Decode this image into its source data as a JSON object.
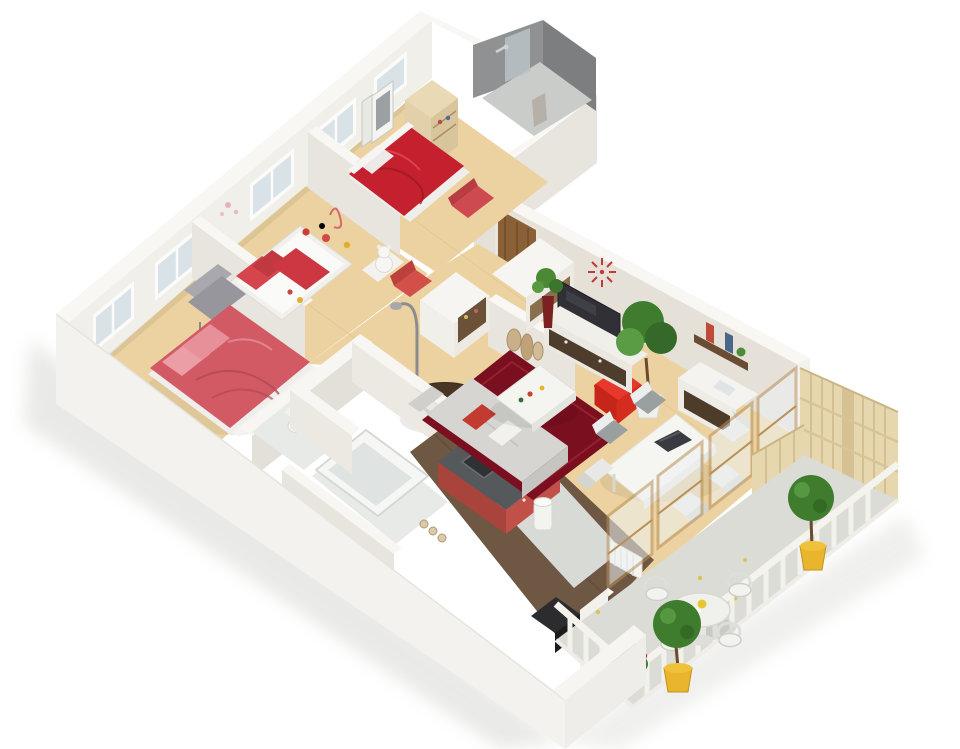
{
  "scene": {
    "type": "3d-isometric-floor-plan-render",
    "subject": "Furnished apartment dollhouse cutaway: three bedrooms, shower room, bathroom, kitchen, living-dining room and terrace balcony",
    "background": "#ffffff",
    "image_width_px": 960,
    "image_height_px": 749,
    "text_labels": "none"
  },
  "palette": {
    "wall_top": "#f8f7f3",
    "wall_inner": "#f1efe9",
    "wall_shadow": "#e8e5df",
    "wall_dark": "#dcd9d2",
    "wood_floor": "#ebd2a0",
    "tile_floor": "#e7eae6",
    "kitchen_floor": "#6e5743",
    "balcony_floor": "#dcdcd6",
    "rug_red": "#7a0f1f",
    "bed_red": "#c5202e",
    "bed_pink": "#d25a64",
    "accent_red": "#e6392c",
    "sofa_gray": "#d6d5d1",
    "door_wood": "#8a6136",
    "furniture_wood": "#4e3d2d",
    "fence_wood": "#e7d7ae",
    "railing_white": "#f4f3ee",
    "plant_green": "#3f7c2e",
    "plant_green_light": "#5a9c44",
    "pot_yellow": "#e8b52c",
    "shower_tile": "#8f9192",
    "glass": "#b9c2c6",
    "counter_red": "#c05048",
    "counter_top": "#55595c"
  },
  "rooms": [
    {
      "id": "master-bedroom",
      "position": "lower-left",
      "floor": "wood",
      "items": [
        "double-bed-pink",
        "gray-armchair",
        "two-windows"
      ]
    },
    {
      "id": "kids-bedroom",
      "position": "center-left",
      "floor": "wood",
      "items": [
        "kids-bed-red-pillows",
        "toys",
        "teddy-bear",
        "red-kid-armchair",
        "window"
      ]
    },
    {
      "id": "bedroom-3",
      "position": "top-center",
      "floor": "wood",
      "items": [
        "double-bed-red-duvet",
        "wardrobe",
        "picture-frames",
        "red-bench"
      ]
    },
    {
      "id": "shower-room",
      "position": "top-right-block",
      "floor": "gray-tile",
      "items": [
        "glass-shower",
        "hanging-robe"
      ]
    },
    {
      "id": "entry-hall",
      "position": "center",
      "floor": "wood",
      "items": [
        "entrance-door",
        "dresser-cabinets",
        "arc-floor-lamp",
        "round-dark-table"
      ]
    },
    {
      "id": "bathroom-wc",
      "position": "bottom-center-left",
      "floor": "white-tile",
      "items": [
        "bathtub",
        "toilet"
      ]
    },
    {
      "id": "kitchen",
      "position": "bottom-center",
      "floor": "dark-wood",
      "items": [
        "l-counter-red-front",
        "sink",
        "trash-bin",
        "oven",
        "bottles",
        "radiator"
      ]
    },
    {
      "id": "living-dining",
      "position": "center-right",
      "floor": "wood",
      "items": [
        "dark-red-rug",
        "white-coffee-table",
        "gray-corner-sofa",
        "red-pouf",
        "tv-stand",
        "tv",
        "red-wall-clock",
        "floor-vases",
        "potted-tree",
        "wall-shelf-books",
        "white-sideboard",
        "dining-table",
        "six-dining-chairs",
        "sliding-glass-doors"
      ]
    },
    {
      "id": "balcony",
      "position": "bottom-right",
      "floor": "gray-pavers",
      "items": [
        "wood-privacy-fence",
        "white-picket-railing",
        "round-outdoor-table",
        "four-outdoor-chairs",
        "two-potted-trees",
        "red-flower-planter",
        "scattered-leaves"
      ]
    }
  ],
  "counts": {
    "windows_nw_wall": 5,
    "glass_door_panels": 4,
    "dining_chairs": 6,
    "outdoor_chairs": 4,
    "balcony_potted_trees": 2
  }
}
